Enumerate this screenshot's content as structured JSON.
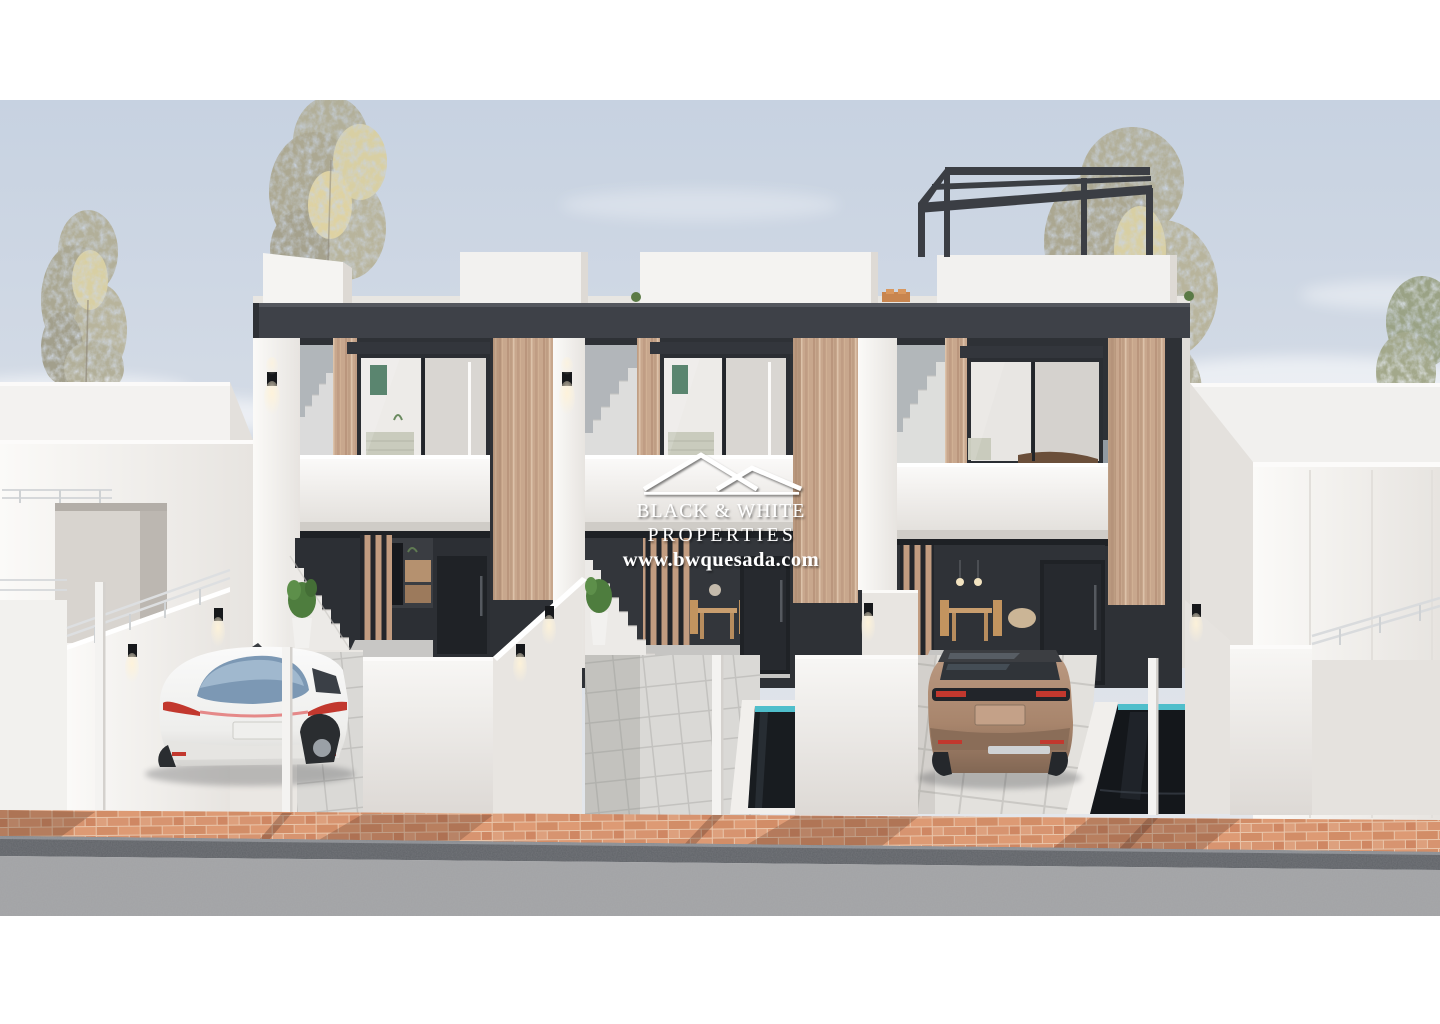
{
  "watermark": {
    "brand_line1": "BLACK & WHITE",
    "brand_line2": "PROPERTIES",
    "website": "www.bwquesada.com",
    "logo": "double-roof-outline-icon"
  },
  "scene": {
    "type": "3d-architectural-render",
    "setting": "street-level view of three modern two-storey white townhouses with dark fascia and wood pillars",
    "objects": {
      "townhouse_count": 3,
      "left_vehicle": "white sedan parked on left driveway",
      "right_vehicle": "bronze suv parked on right driveway",
      "pools": "two small private plunge pools with dark water and turquoise waterline",
      "roof_feature": "black aluminium pergola on right rooftop terrace",
      "landscaping": "potted plants, boulder with grasses, slender autumn trees",
      "lighting": "black wall sconces with warm glow",
      "foreground": "terracotta brick sidewalk, dark curb, asphalt road",
      "background": "pale blue sky with soft clouds, neighbouring white buildings"
    }
  },
  "palette": {
    "frame": "#ffffff",
    "sky_top": "#c7d2e1",
    "sky_bottom": "#e7e9ec",
    "wall_white": "#f6f5f3",
    "wall_shade": "#e9e6e2",
    "fascia": "#3e4148",
    "wood": "#c8a78d",
    "recess_dark": "#2e3136",
    "interior_light": "#edebe8",
    "tile": "#d8d7d4",
    "concrete": "#eae7e3",
    "brick": "#d99a74",
    "curb": "#5f6267",
    "road": "#a2a3a5",
    "water": "#181c20",
    "waterline": "#4fbecb",
    "foliage": "#b2af99",
    "glow": "#fff3d8",
    "taillight": "#c2382e",
    "sedan": "#f6f6f5",
    "suv": "#a8856c",
    "watermark": "#ffffff"
  }
}
